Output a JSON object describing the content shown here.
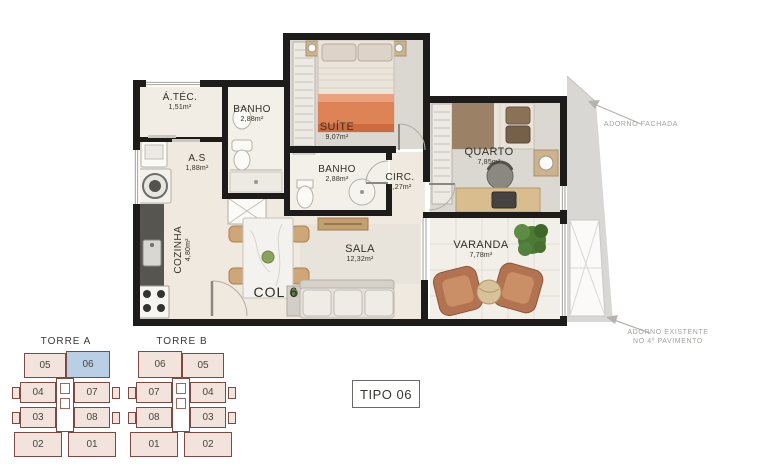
{
  "colors": {
    "wall": "#1d1c1a",
    "floor_cream": "#efe9df",
    "floor_carpet": "#dbd8d1",
    "bedding_orange": "#de8355",
    "wood": "#cdb38c",
    "armchair_copper": "#b37350",
    "plant_green": "#4c7a34",
    "adorno_gray": "#d8d7d3",
    "tower_outline": "#7d4a42",
    "tower_fill": "#f2e4dc",
    "tower_highlight": "#b9cfe6",
    "annotation_gray": "#a3a29e"
  },
  "plan": {
    "rooms": {
      "atec": {
        "label": "Á.TÉC.",
        "area": "1,51m²"
      },
      "banho1": {
        "label": "BANHO",
        "area": "2,88m²"
      },
      "suite": {
        "label": "SUÍTE",
        "area": "9,07m²"
      },
      "as": {
        "label": "A.S",
        "area": "1,88m²"
      },
      "banho2": {
        "label": "BANHO",
        "area": "2,88m²"
      },
      "circ": {
        "label": "CIRC.",
        "area": "1,27m²"
      },
      "quarto": {
        "label": "QUARTO",
        "area": "7,85m²"
      },
      "cozinha": {
        "label": "COZINHA",
        "area": "4,80m²"
      },
      "sala": {
        "label": "SALA",
        "area": "12,32m²"
      },
      "varanda": {
        "label": "VARANDA",
        "area": "7,78m²"
      }
    },
    "column_label": "COL 6"
  },
  "annotations": {
    "facade": "ADORNO FACHADA",
    "existing_line1": "ADORNO EXISTENTE",
    "existing_line2": "NO 4º PAVIMENTO"
  },
  "towers": {
    "a": {
      "name": "TORRE A",
      "highlighted_unit": "06",
      "rows": [
        [
          "05",
          "06"
        ],
        [
          "04",
          "07"
        ],
        [
          "03",
          "08"
        ],
        [
          "02",
          "01"
        ]
      ]
    },
    "b": {
      "name": "TORRE B",
      "rows": [
        [
          "06",
          "05"
        ],
        [
          "07",
          "04"
        ],
        [
          "08",
          "03"
        ],
        [
          "01",
          "02"
        ]
      ]
    }
  },
  "type_label": "TIPO 06"
}
